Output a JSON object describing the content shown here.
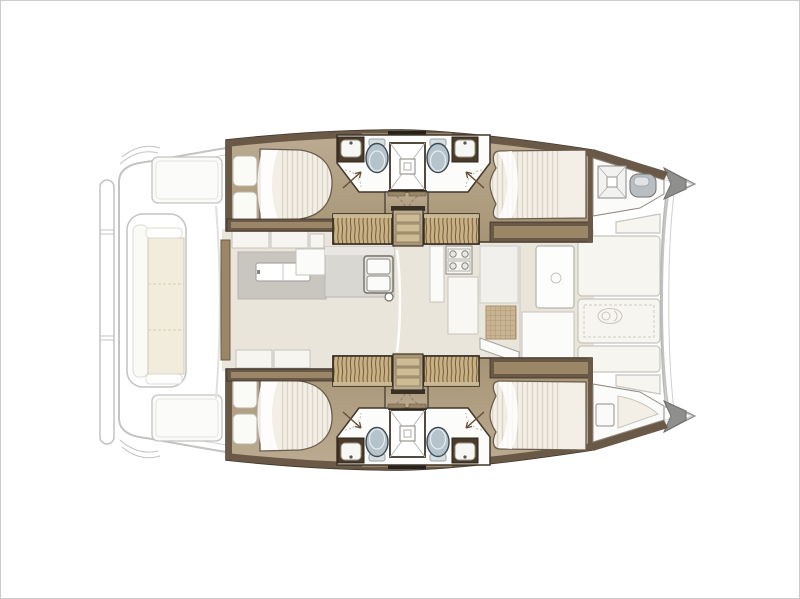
{
  "page": {
    "description": "Top-down interior layout plan of a four-cabin sailing catamaran, bow pointing right, no text labels"
  },
  "palette": {
    "frame": "#cccccc",
    "paper": "#ffffff",
    "faded": "#c3c3c1",
    "ink": "#3f362b",
    "wall-dark": "#6b5948",
    "wall-black": "#26211b",
    "wood-top": "#bcac92",
    "wood-bottom": "#a79475",
    "wood-mid": "#9b8768",
    "wood-light": "#cdbb96",
    "steps": "#c9b183",
    "steps-stripe": "#6f5c41",
    "bed": "#f3efe6",
    "bed-line": "#6b5d4c",
    "pillow": "#fafaf7",
    "bath": "#fcfcfa",
    "toilet": "#b5c3cc",
    "saloon": "#eae5da",
    "rug": "#c9c6c0",
    "counter": "#d9d7d2",
    "white-soft": "#f7f5ef",
    "mat": "#c8b493",
    "cap": "#8f8f8d",
    "cream": "#f1ecdb",
    "cream-line": "#d9d2b8"
  },
  "plan": {
    "vessel_type": "catamaran-floor-plan",
    "orientation": "bow-right",
    "areas": [
      {
        "name": "stern-platform",
        "items": [
          "transom-strip",
          "corner-steps"
        ]
      },
      {
        "name": "aft-cockpit",
        "items": [
          "deck-locker-port",
          "deck-locker-starboard",
          "bench-with-cushions"
        ]
      },
      {
        "name": "port-hull",
        "items": [
          "aft-double-bed",
          "bathroom-sink-x2",
          "toilet-x2",
          "central-shower",
          "companionway-steps",
          "forward-double-bed",
          "forepeak-hatch",
          "windlass"
        ]
      },
      {
        "name": "starboard-hull",
        "items": [
          "aft-double-bed",
          "bathroom-sink-x2",
          "toilet-x2",
          "central-shower",
          "companionway-steps",
          "forward-double-bed",
          "storage-box",
          "forepeak-berth"
        ]
      },
      {
        "name": "saloon",
        "items": [
          "sliding-rear-door",
          "dinette-rug",
          "dinette-table",
          "sofa-segments",
          "galley-counter",
          "double-sink",
          "faucet",
          "stove",
          "fridge-cabinets",
          "entry-mat",
          "forward-door"
        ]
      },
      {
        "name": "forward-cockpit",
        "items": [
          "sunpad-panel-x5",
          "stitched-cushion",
          "brand-logo-emblem",
          "bow-caps"
        ]
      }
    ]
  }
}
